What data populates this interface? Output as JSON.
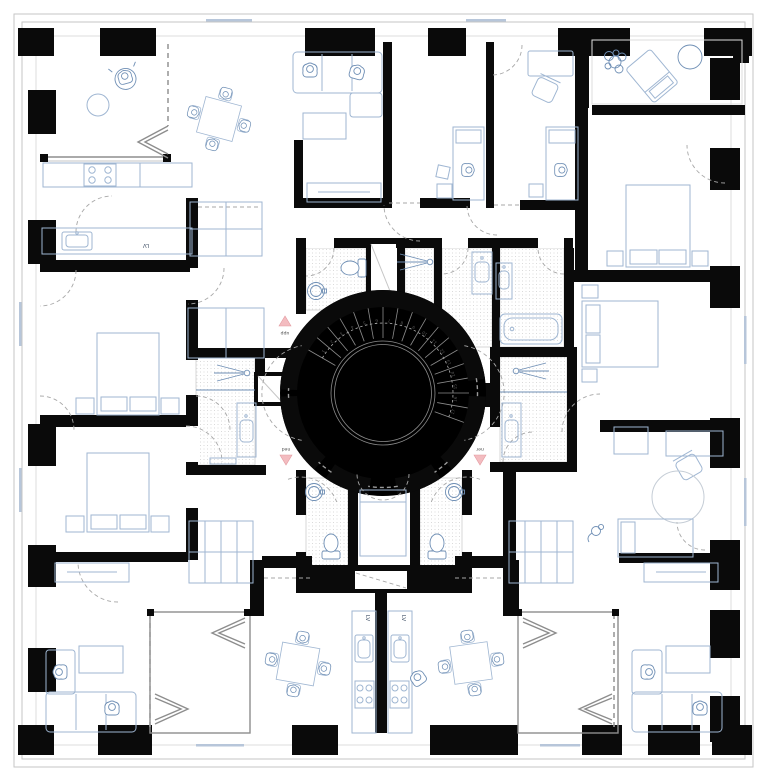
{
  "drawing": {
    "type": "residential-floor-plan",
    "labels": {
      "dishwasher_top_left": "LV",
      "dishwasher_bottom_left": "LV",
      "dishwasher_bottom_right": "LV",
      "stair_up": "upp",
      "stair_down_left": "ned",
      "stair_down_right": "ner"
    },
    "stair": {
      "step_labels": [
        "1",
        "2",
        "3",
        "4",
        "5",
        "6",
        "7",
        "8",
        "9",
        "10",
        "11",
        "12",
        "13",
        "14",
        "15",
        "16",
        "17"
      ]
    },
    "palette": {
      "wall": "#0a0a0a",
      "furniture": "#9fb6d2",
      "furniture_dark": "#6f8fb5",
      "facade_line": "#c6c6c6",
      "dashed_line": "#a7a7a7",
      "stipple_dot": "#c9c9c9",
      "arrow_fill": "#f3bcc0",
      "arrow_stroke": "#e39aa0",
      "label_blue": "#44546a"
    }
  }
}
